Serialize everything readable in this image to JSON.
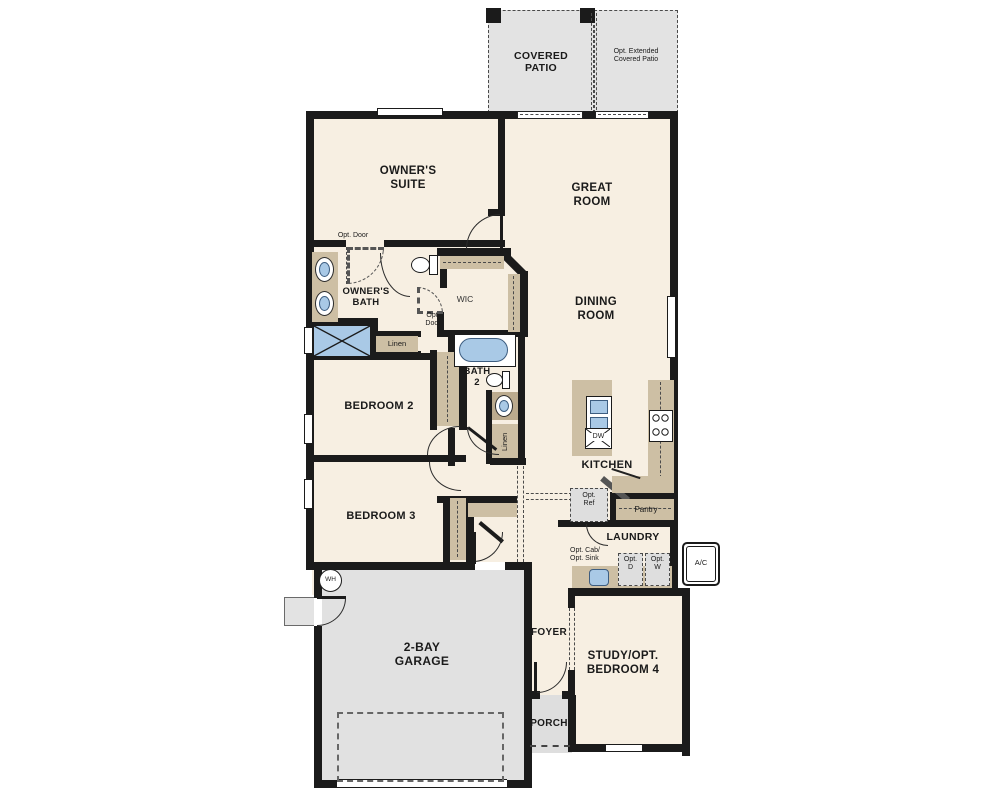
{
  "plan_title": "Single-story floor plan",
  "colors": {
    "room_fill": "#f7efe2",
    "patio_garage_fill": "#e3e3e3",
    "cabinet_tan": "#cdbfa4",
    "fixture_blue": "#a9c9e6",
    "wall_black": "#1b1b1b"
  },
  "labels": {
    "covered_patio": "COVERED\nPATIO",
    "opt_extended_patio": "Opt. Extended\nCovered Patio",
    "owners_suite": "OWNER'S\nSUITE",
    "great_room": "GREAT\nROOM",
    "dining_room": "DINING\nROOM",
    "owners_bath": "OWNER'S\nBATH",
    "wic": "WIC",
    "opt_door_top": "Opt. Door",
    "opt_door_wic": "Opt.\nDoor",
    "linen_owners": "Linen",
    "bath2": "BATH\n2",
    "linen_bath2": "Linen",
    "bedroom2": "BEDROOM 2",
    "bedroom3": "BEDROOM 3",
    "kitchen": "KITCHEN",
    "dw": "DW",
    "opt_ref": "Opt.\nRef",
    "pantry": "Pantry",
    "laundry": "LAUNDRY",
    "opt_cab_sink": "Opt. Cab/\nOpt. Sink",
    "opt_d": "Opt.\nD",
    "opt_w": "Opt.\nW",
    "ac": "A/C",
    "wh": "WH",
    "garage": "2-BAY\nGARAGE",
    "foyer": "FOYER",
    "porch": "PORCH",
    "study": "STUDY/OPT.\nBEDROOM 4"
  }
}
